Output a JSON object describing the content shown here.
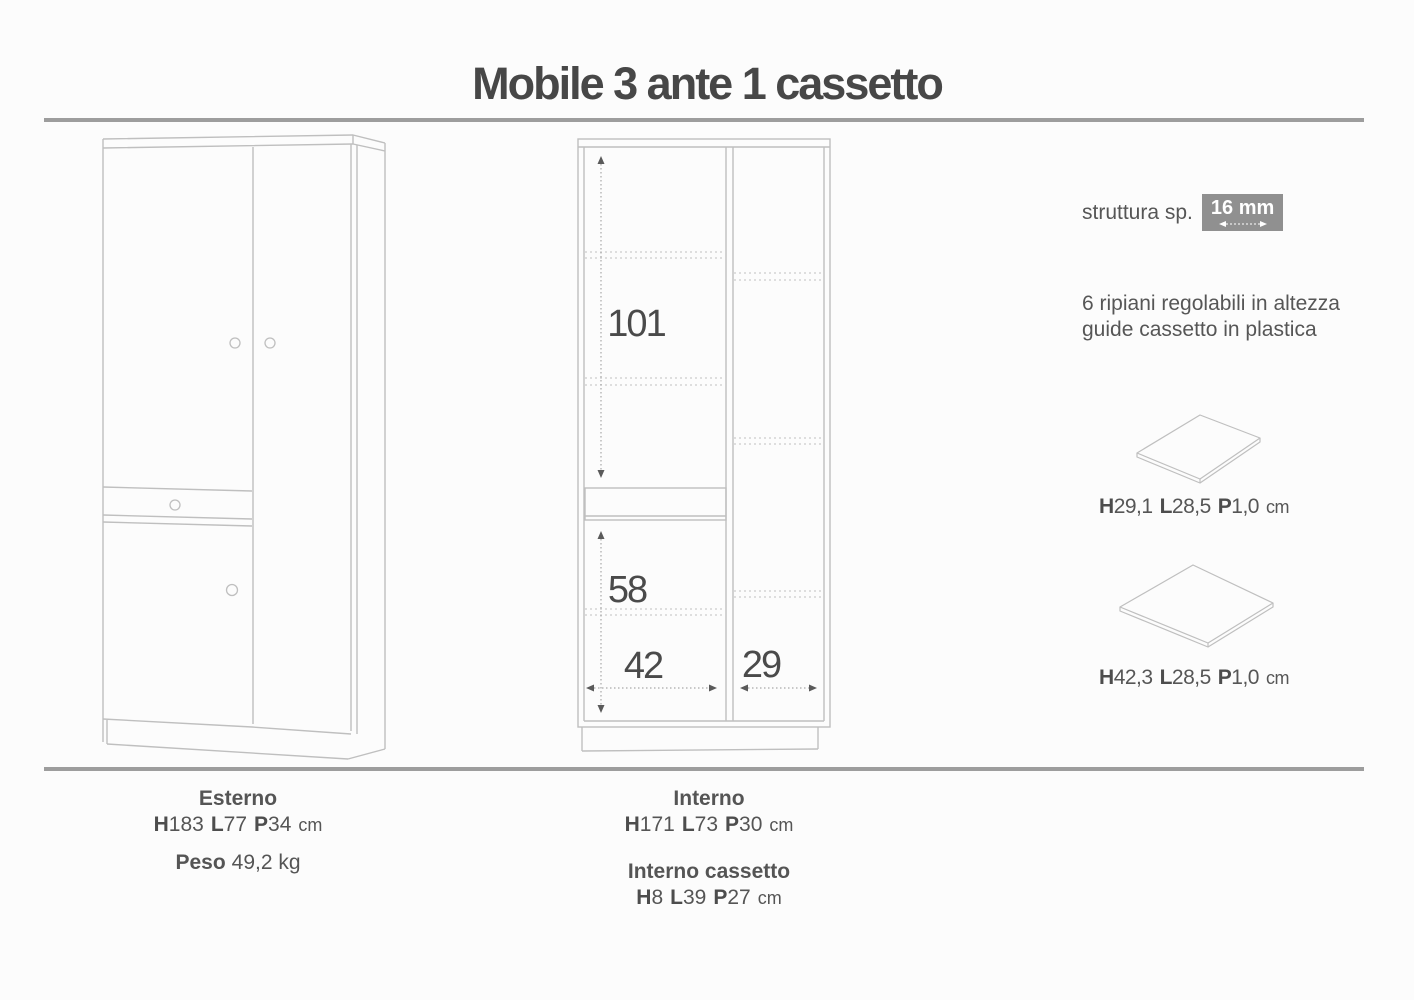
{
  "title": "Mobile 3 ante 1 cassetto",
  "right_panel": {
    "struttura_label": "struttura sp.",
    "struttura_value": "16 mm",
    "feature_line1": "6 ripiani regolabili in altezza",
    "feature_line2": "guide cassetto in plastica",
    "shelf_small": {
      "labelH": "H",
      "valH": "29,1",
      "labelL": "L",
      "valL": "28,5",
      "labelP": "P",
      "valP": "1,0",
      "unit": "cm"
    },
    "shelf_large": {
      "labelH": "H",
      "valH": "42,3",
      "labelL": "L",
      "valL": "28,5",
      "labelP": "P",
      "valP": "1,0",
      "unit": "cm"
    }
  },
  "diagram_dims": {
    "upper_height": "101",
    "lower_height": "58",
    "left_width": "42",
    "right_width": "29"
  },
  "footer": {
    "esterno": {
      "title": "Esterno",
      "labelH": "H",
      "valH": "183",
      "labelL": "L",
      "valL": "77",
      "labelP": "P",
      "valP": "34",
      "unit": "cm",
      "peso_label": "Peso",
      "peso_value": "49,2 kg"
    },
    "interno": {
      "title": "Interno",
      "labelH": "H",
      "valH": "171",
      "labelL": "L",
      "valL": "73",
      "labelP": "P",
      "valP": "30",
      "unit": "cm"
    },
    "interno_cassetto": {
      "title": "Interno cassetto",
      "labelH": "H",
      "valH": "8",
      "labelL": "L",
      "valL": "39",
      "labelP": "P",
      "valP": "27",
      "unit": "cm"
    }
  },
  "colors": {
    "text_dark": "#474747",
    "text_body": "#565656",
    "divider_gray": "#9d9d9d",
    "drawing_line": "#bfbfbf",
    "badge_bg": "#909090",
    "badge_text": "#ffffff"
  }
}
